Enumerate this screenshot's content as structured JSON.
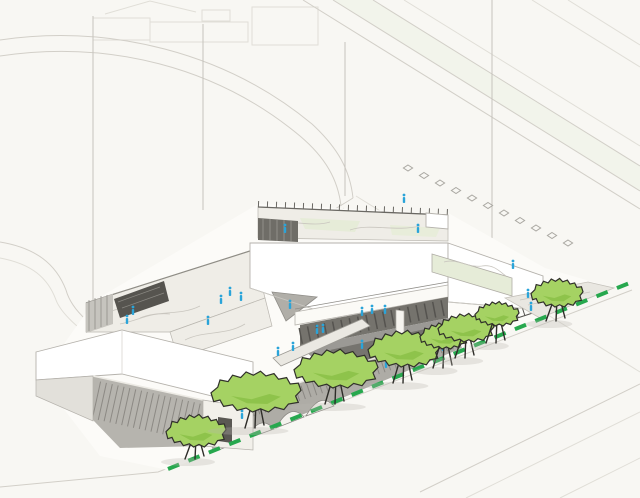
{
  "scene_type": "architectural-axonometric-site-rendering",
  "colors": {
    "background": "#f8f7f3",
    "paper_lines": "#d2cfc8",
    "roof_white": "#ffffff",
    "facade_gray": "#aeaca6",
    "facade_dark": "#6f6d67",
    "louver_line": "#82807a",
    "terrace_floor": "#efede7",
    "courtyard_ground": "#9b9995",
    "courtyard_dark": "#76746f",
    "glass_wall": "#75736d",
    "roof_garden_green": "#e6ecd8",
    "tree_canopy": "#a5d263",
    "tree_canopy_shade": "#8cc148",
    "tree_outline": "#30302a",
    "trunk": "#2e2d29",
    "property_line_green": "#27a84e",
    "figure_blue": "#2aa4d9",
    "marker_stroke": "#aaa8a2"
  },
  "scene": {
    "street_tree_count": 8,
    "figure_count": 24,
    "lane_marker_count": 11,
    "street_trees": [
      [
        196,
        431,
        30,
        16,
        459
      ],
      [
        256,
        392,
        45,
        20,
        428
      ],
      [
        336,
        369,
        42,
        19,
        404
      ],
      [
        404,
        349,
        36,
        18,
        383
      ],
      [
        444,
        336,
        24,
        13,
        368
      ],
      [
        466,
        328,
        28,
        14,
        358
      ],
      [
        497,
        314,
        22,
        12,
        343
      ],
      [
        557,
        293,
        26,
        14,
        321
      ]
    ],
    "figures": [
      [
        285,
        233
      ],
      [
        404,
        203
      ],
      [
        418,
        233
      ],
      [
        133,
        315
      ],
      [
        127,
        324
      ],
      [
        208,
        325
      ],
      [
        221,
        304
      ],
      [
        230,
        296
      ],
      [
        241,
        301
      ],
      [
        290,
        309
      ],
      [
        362,
        316
      ],
      [
        372,
        314
      ],
      [
        385,
        314
      ],
      [
        323,
        333
      ],
      [
        293,
        351
      ],
      [
        362,
        349
      ],
      [
        386,
        368
      ],
      [
        443,
        351
      ],
      [
        513,
        269
      ],
      [
        528,
        298
      ],
      [
        531,
        311
      ],
      [
        278,
        356
      ],
      [
        317,
        334
      ],
      [
        242,
        419
      ]
    ],
    "lane_markers": {
      "start": [
        408,
        168
      ],
      "step": [
        16,
        7.5
      ],
      "count": 11
    },
    "property_line": {
      "from": [
        168,
        469
      ],
      "to": [
        632,
        282
      ],
      "dash": [
        12,
        10
      ]
    },
    "reference_lines": [
      [
        492,
        0,
        254
      ],
      [
        93,
        16,
        300
      ],
      [
        203,
        24,
        210
      ],
      [
        345,
        42,
        196
      ]
    ]
  }
}
